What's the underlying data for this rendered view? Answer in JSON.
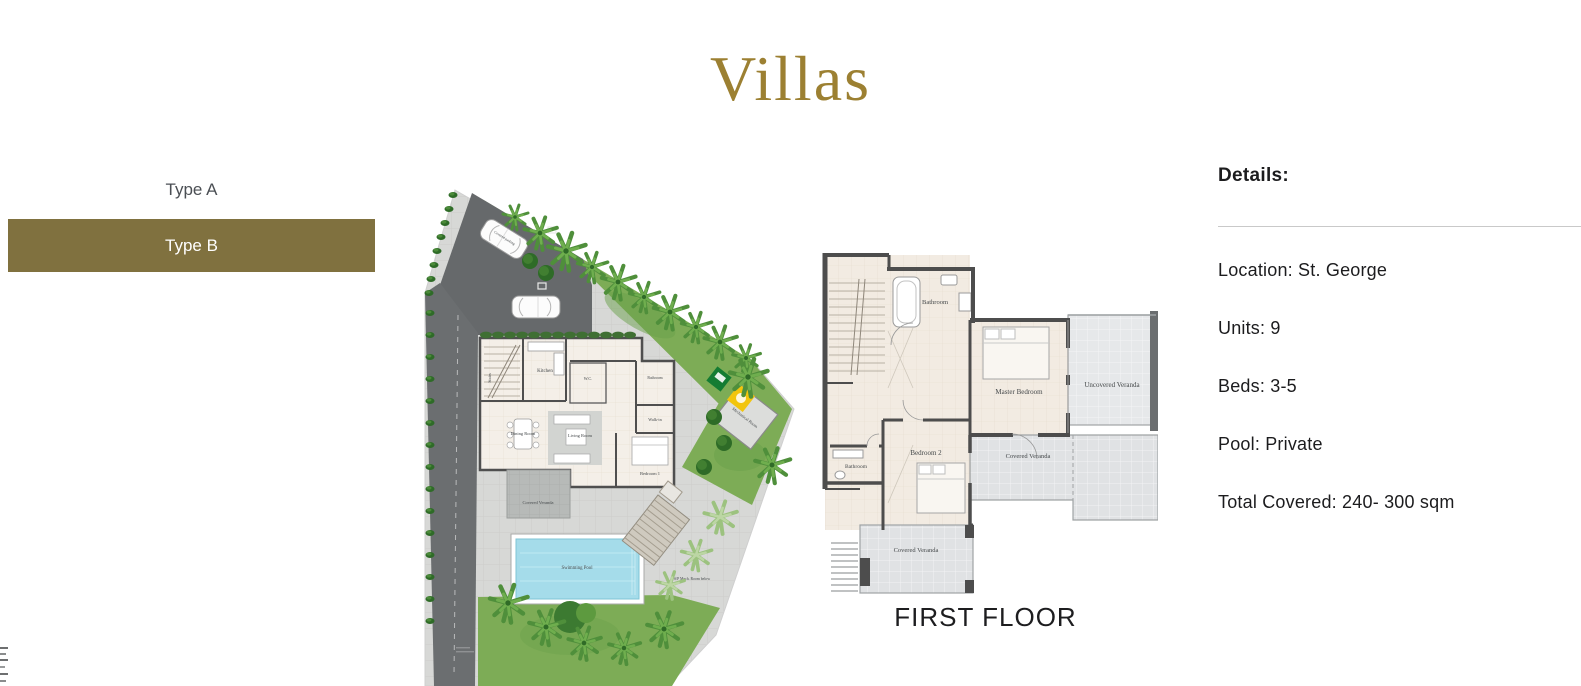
{
  "page": {
    "title": "Villas"
  },
  "colors": {
    "accent_gold": "#9c8032",
    "selected_button_brown": "#80713f",
    "text_dark": "#1c1c1e",
    "pool_blue": "#a5dcea",
    "grass_green": "#7dac56"
  },
  "type_selector": {
    "options": [
      {
        "label": "Type A",
        "selected": false
      },
      {
        "label": "Type B",
        "selected": true
      }
    ]
  },
  "details": {
    "heading": "Details:",
    "items": [
      "Location: St. George",
      "Units: 9",
      "Beds: 3-5",
      "Pool: Private",
      "Total Covered: 240- 300 sqm"
    ]
  },
  "site_plan": {
    "labels": {
      "parking": "Covered parking",
      "kitchen": "Kitchen",
      "stairs": "Stairs",
      "wc": "W.C.",
      "bathroom": "Bathroom",
      "walk_in": "Walk-in",
      "dining_room": "Dining Room",
      "living_room": "Living Room",
      "bedroom_1": "Bedroom 1",
      "covered_veranda": "Covered Veranda",
      "mechanical_room": "Mechanical Room",
      "swimming_pool": "Swimming Pool",
      "sp_mech": "S/P Mech. Room below"
    }
  },
  "first_floor": {
    "caption": "FIRST FLOOR",
    "rooms": {
      "bathroom_top": "Bathroom",
      "master_bedroom": "Master Bedroom",
      "uncovered_veranda": "Uncovered Veranda",
      "bedroom_2": "Bedroom 2",
      "bathroom_left": "Bathroom",
      "covered_veranda_right": "Covered Veranda",
      "covered_veranda_bottom": "Covered Veranda"
    }
  }
}
